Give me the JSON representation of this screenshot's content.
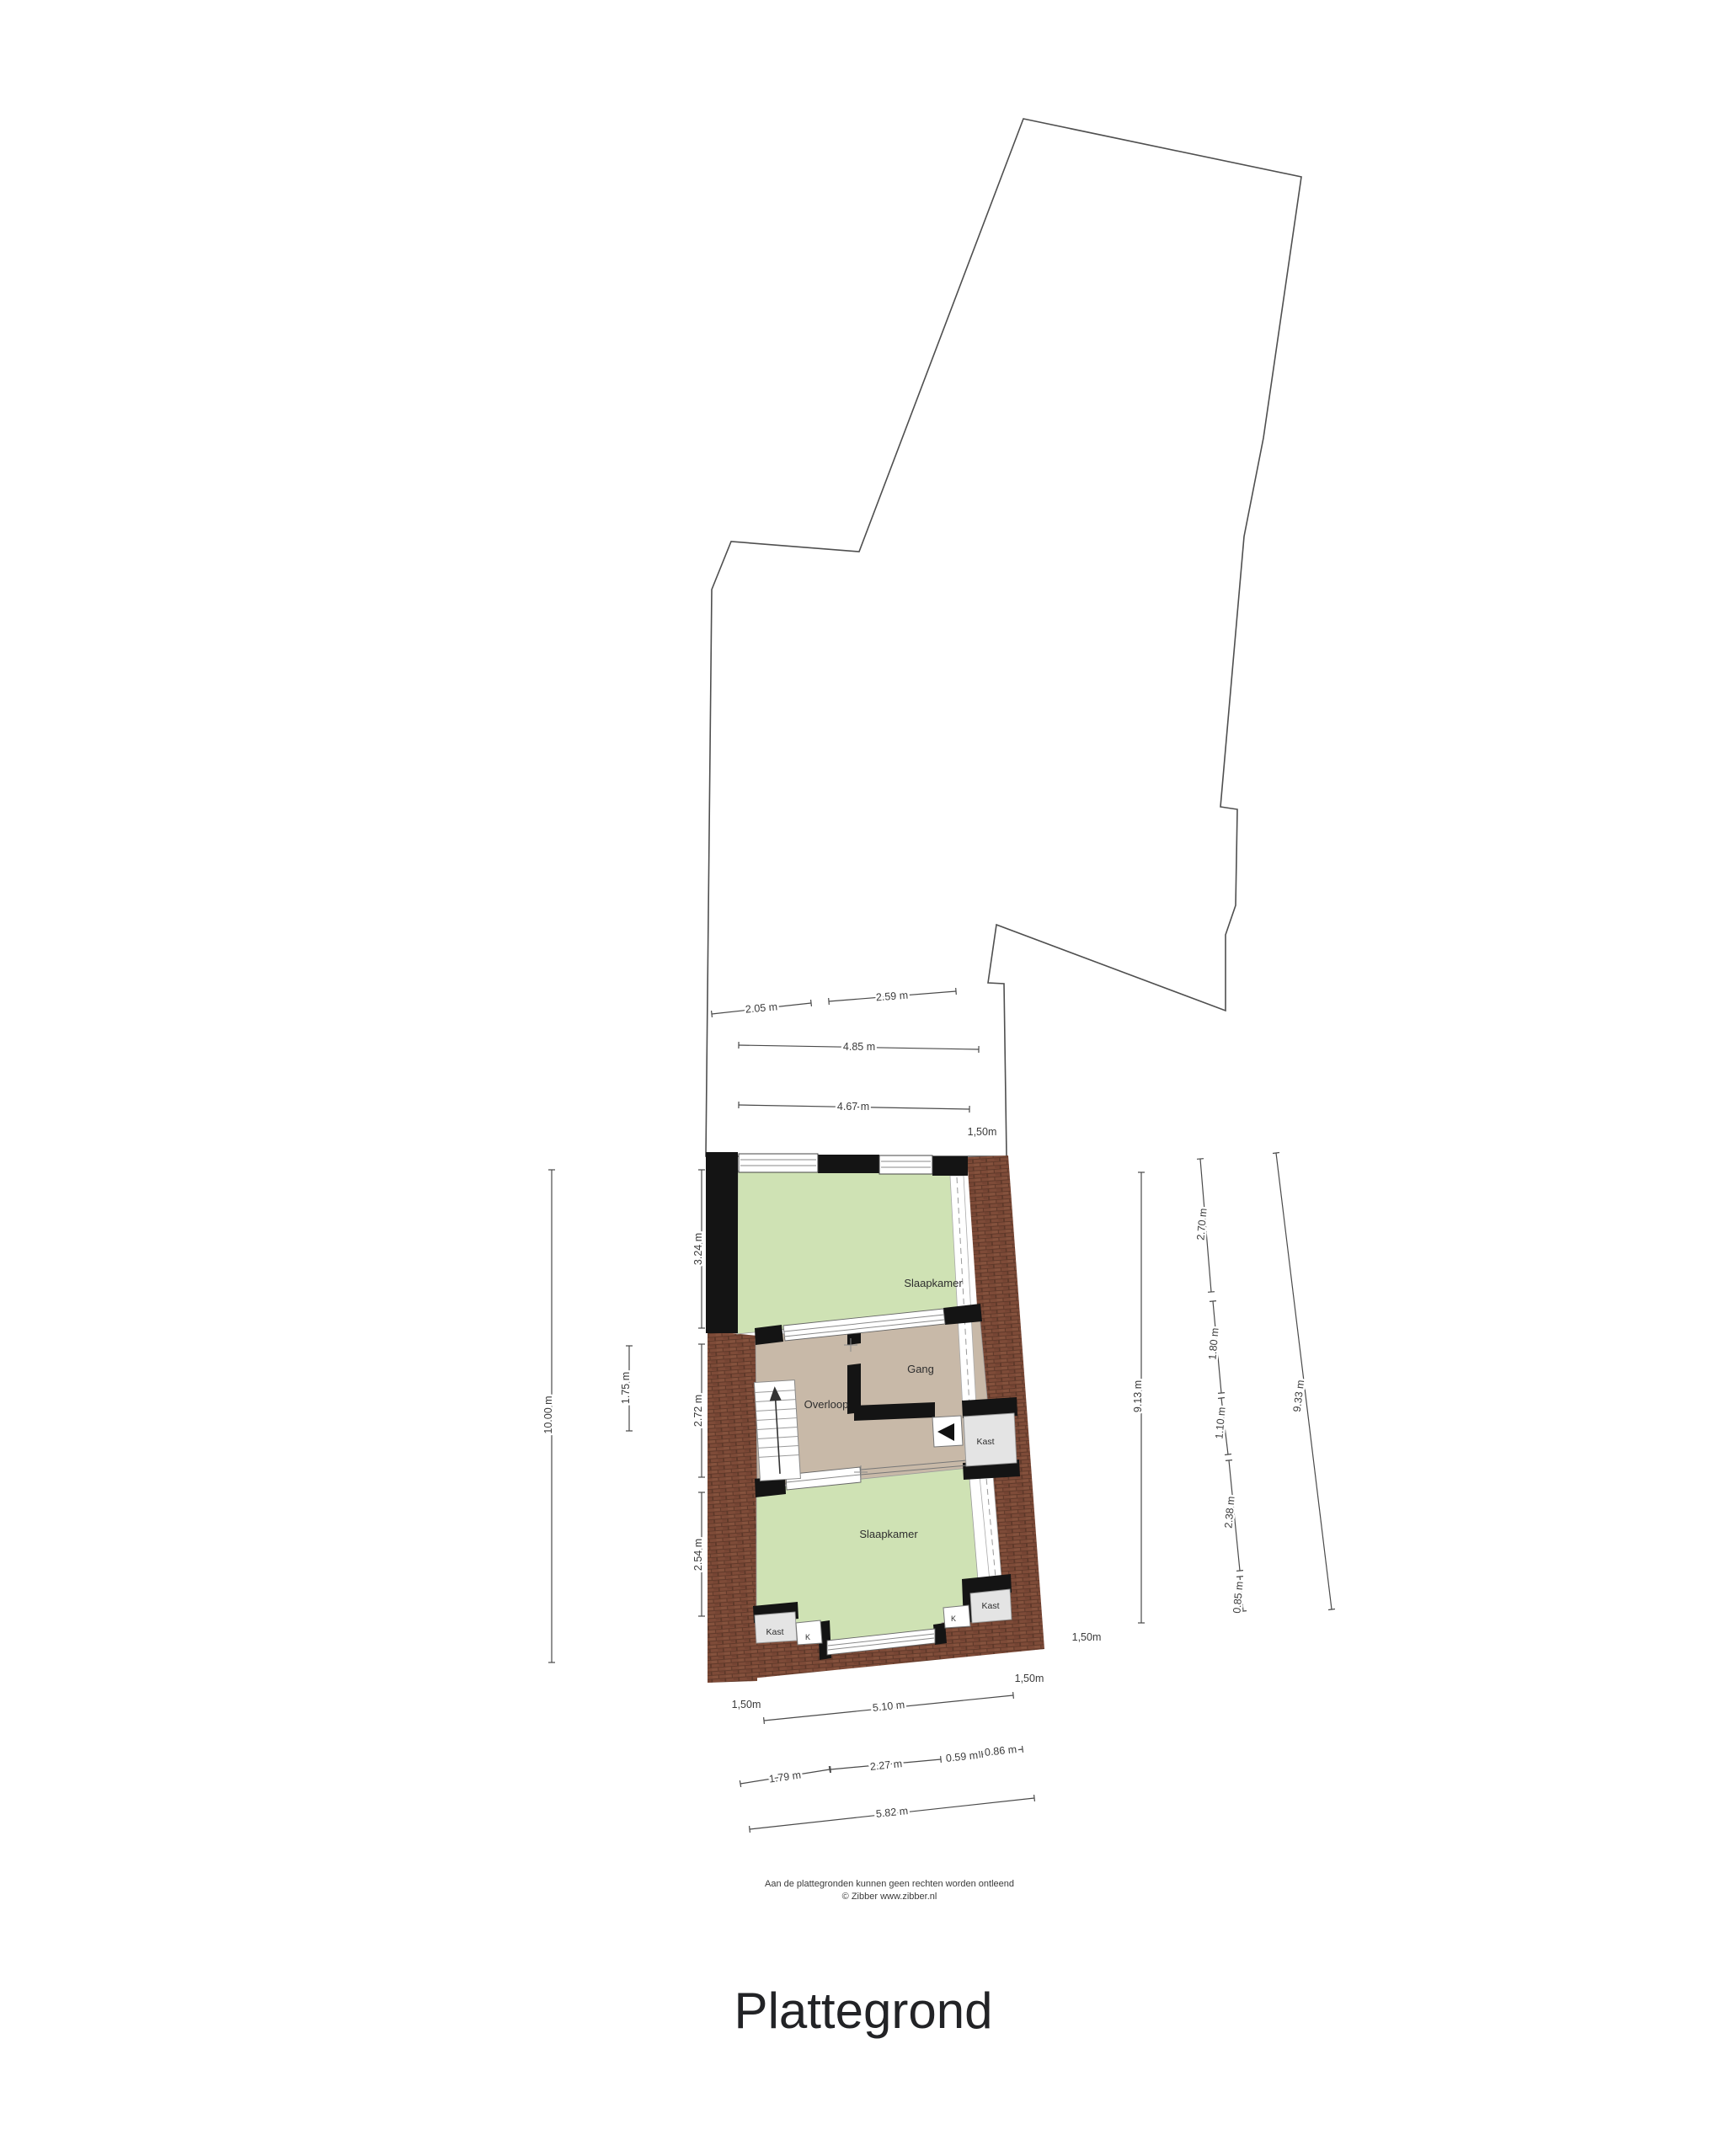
{
  "title": "Plattegrond",
  "footer": {
    "disclaimer": "Aan de plattegronden kunnen geen rechten worden ontleend",
    "copyright": "© Zibber www.zibber.nl"
  },
  "rooms": {
    "slaapkamer_top": "Slaapkamer",
    "gang": "Gang",
    "overloop": "Overloop",
    "kast_mid": "Kast",
    "slaapkamer_bottom": "Slaapkamer",
    "kast_bl": "Kast",
    "k_bl": "K",
    "kast_br": "Kast",
    "k_br": "K"
  },
  "dims": [
    {
      "label": "2.05 m"
    },
    {
      "label": "2.59 m"
    },
    {
      "label": "4.85 m"
    },
    {
      "label": "4.67 m"
    },
    {
      "label": "1,50m"
    },
    {
      "label": "3.24 m"
    },
    {
      "label": "2.72 m"
    },
    {
      "label": "2.54 m"
    },
    {
      "label": "1.75 m"
    },
    {
      "label": "10.00 m"
    },
    {
      "label": "9.13 m"
    },
    {
      "label": "2.70 m"
    },
    {
      "label": "1.80 m"
    },
    {
      "label": "1.10 m"
    },
    {
      "label": "2.38 m"
    },
    {
      "label": "0.85 m"
    },
    {
      "label": "9.33 m"
    },
    {
      "label": "1,50m"
    },
    {
      "label": "1,50m"
    },
    {
      "label": "1,50m"
    },
    {
      "label": "5.10 m"
    },
    {
      "label": "1.79 m"
    },
    {
      "label": "2.27 m"
    },
    {
      "label": "0.59 m"
    },
    {
      "label": "0.86 m"
    },
    {
      "label": "5.82 m"
    }
  ],
  "colors": {
    "bedroom_green": "#cfe2b4",
    "hall_taupe": "#c8b9a8",
    "closet_gray": "#e4e4e4",
    "brick": "#7e4b38",
    "brick_mortar": "#5d3829",
    "wall_black": "#141414",
    "outline_gray": "#4f4f4f"
  }
}
